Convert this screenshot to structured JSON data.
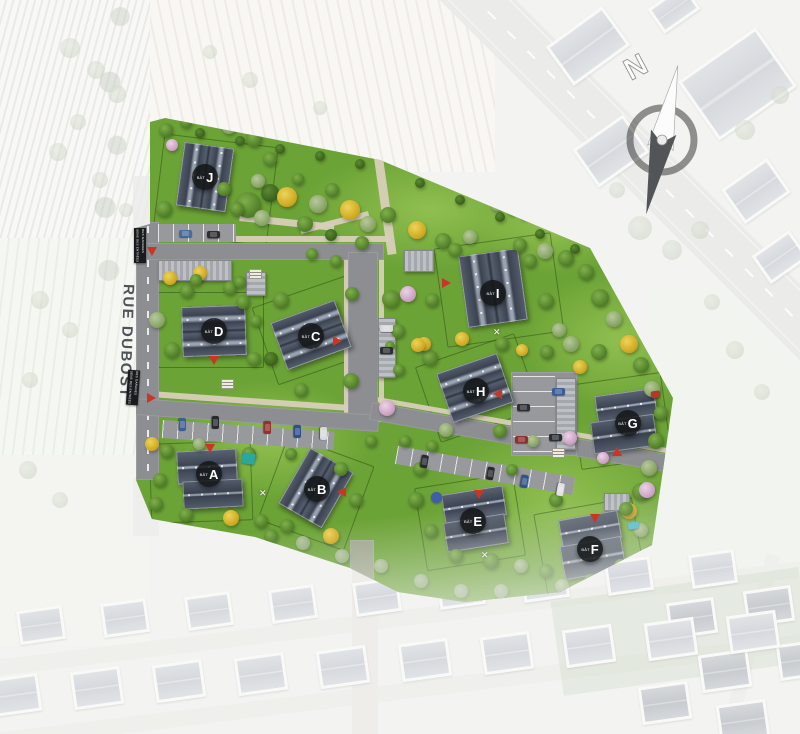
{
  "map": {
    "street_label": "RUE DUBOST",
    "compass": {
      "label": "N"
    },
    "building_prefix": "BÂT",
    "buildings": [
      {
        "id": "A",
        "badge": {
          "x": 209,
          "y": 474
        },
        "wings": [
          [
            177,
            450,
            60,
            33,
            -3,
            "1h"
          ],
          [
            183,
            480,
            60,
            28,
            -3,
            "1h"
          ]
        ]
      },
      {
        "id": "B",
        "badge": {
          "x": 317,
          "y": 489
        },
        "wings": [
          [
            291,
            456,
            50,
            64,
            30,
            "2v"
          ]
        ]
      },
      {
        "id": "C",
        "badge": {
          "x": 311,
          "y": 336
        },
        "wings": [
          [
            277,
            310,
            68,
            50,
            -20,
            "2h"
          ]
        ]
      },
      {
        "id": "D",
        "badge": {
          "x": 214,
          "y": 331
        },
        "wings": [
          [
            182,
            306,
            64,
            50,
            -2,
            "2h"
          ]
        ]
      },
      {
        "id": "E",
        "badge": {
          "x": 473,
          "y": 521
        },
        "wings": [
          [
            443,
            490,
            62,
            30,
            -9,
            "1h"
          ],
          [
            445,
            518,
            62,
            30,
            -9,
            "1h"
          ]
        ]
      },
      {
        "id": "F",
        "badge": {
          "x": 590,
          "y": 549
        },
        "wings": [
          [
            560,
            515,
            60,
            28,
            -10,
            "1h"
          ],
          [
            562,
            541,
            62,
            34,
            -10,
            "1h"
          ]
        ]
      },
      {
        "id": "G",
        "badge": {
          "x": 628,
          "y": 423
        },
        "wings": [
          [
            596,
            392,
            60,
            28,
            -8,
            "1h"
          ],
          [
            592,
            418,
            64,
            32,
            -8,
            "1h"
          ]
        ]
      },
      {
        "id": "H",
        "badge": {
          "x": 476,
          "y": 391
        },
        "wings": [
          [
            443,
            362,
            64,
            52,
            -19,
            "2h"
          ]
        ]
      },
      {
        "id": "I",
        "badge": {
          "x": 493,
          "y": 293
        },
        "wings": [
          [
            463,
            252,
            60,
            72,
            -8,
            "2v"
          ]
        ]
      },
      {
        "id": "J",
        "badge": {
          "x": 205,
          "y": 177
        },
        "wings": [
          [
            180,
            145,
            50,
            64,
            8,
            "2v"
          ]
        ]
      }
    ],
    "entrance_signs": [
      {
        "x": 134,
        "y": 228,
        "rot": 0,
        "lines": [
          "SENS DES ENTRÉES",
          "DES GARAGES"
        ]
      },
      {
        "x": 127,
        "y": 370,
        "rot": 4,
        "lines": [
          "SENS DES ENTRÉES",
          "DES GARAGES"
        ]
      }
    ],
    "arrows": [
      [
        152,
        252,
        "down"
      ],
      [
        152,
        398,
        "right"
      ],
      [
        210,
        449,
        "down"
      ],
      [
        214,
        361,
        "down"
      ],
      [
        338,
        341,
        "right"
      ],
      [
        342,
        492,
        "left"
      ],
      [
        498,
        394,
        "left"
      ],
      [
        447,
        283,
        "right"
      ],
      [
        479,
        495,
        "down"
      ],
      [
        595,
        519,
        "down"
      ],
      [
        617,
        452,
        "up"
      ]
    ],
    "lot_markers": [
      [
        249,
        269
      ],
      [
        221,
        379
      ],
      [
        552,
        448
      ]
    ],
    "crosses": [
      [
        497,
        332
      ],
      [
        263,
        493
      ],
      [
        485,
        555
      ]
    ],
    "items": [
      {
        "x": 248,
        "y": 458,
        "w": 13,
        "h": 11,
        "c": "#2aa89f",
        "rot": 8,
        "shape": "rect",
        "name": "play-tent"
      },
      {
        "x": 633,
        "y": 525,
        "w": 11,
        "h": 7,
        "c": "#49b8c8",
        "rot": -10,
        "shape": "rect",
        "name": "pool"
      },
      {
        "x": 436,
        "y": 497,
        "w": 11,
        "h": 11,
        "c": "#3f5da8",
        "rot": 0,
        "shape": "circle",
        "name": "parasol"
      },
      {
        "x": 655,
        "y": 394,
        "w": 9,
        "h": 7,
        "c": "#b5372a",
        "rot": -8,
        "shape": "rect",
        "name": "playhouse"
      }
    ],
    "cars": [
      [
        185,
        233,
        0,
        "#4a6c9d"
      ],
      [
        213,
        234,
        0,
        "#2b2f34"
      ],
      [
        182,
        424,
        90,
        "#3c5f95"
      ],
      [
        215,
        422,
        90,
        "#26292e"
      ],
      [
        267,
        427,
        90,
        "#93312e"
      ],
      [
        297,
        431,
        90,
        "#2f4f88"
      ],
      [
        323,
        433,
        90,
        "#d7d9da"
      ],
      [
        523,
        407,
        0,
        "#2b2f35"
      ],
      [
        558,
        391,
        0,
        "#3a5f97"
      ],
      [
        521,
        439,
        0,
        "#8f2f2f"
      ],
      [
        555,
        437,
        0,
        "#2b2f35"
      ],
      [
        424,
        461,
        100,
        "#26292e"
      ],
      [
        490,
        473,
        100,
        "#26292e"
      ],
      [
        524,
        481,
        100,
        "#2f5390"
      ],
      [
        560,
        489,
        100,
        "#e0e1e2"
      ],
      [
        386,
        328,
        0,
        "#d8d9da"
      ],
      [
        386,
        350,
        0,
        "#2b2f35"
      ]
    ],
    "trees": [
      [
        248,
        205,
        13,
        "g"
      ],
      [
        270,
        193,
        9,
        "d"
      ],
      [
        287,
        197,
        10,
        "y"
      ],
      [
        305,
        224,
        8,
        "g"
      ],
      [
        318,
        204,
        9,
        "p"
      ],
      [
        332,
        190,
        7,
        "g"
      ],
      [
        350,
        210,
        10,
        "y"
      ],
      [
        368,
        224,
        8,
        "p"
      ],
      [
        388,
        215,
        8,
        "g"
      ],
      [
        362,
        243,
        7,
        "g"
      ],
      [
        331,
        235,
        6,
        "d"
      ],
      [
        262,
        218,
        8,
        "p"
      ],
      [
        237,
        209,
        7,
        "g"
      ],
      [
        224,
        189,
        7,
        "g"
      ],
      [
        258,
        181,
        7,
        "p"
      ],
      [
        298,
        179,
        6,
        "g"
      ],
      [
        417,
        230,
        9,
        "y"
      ],
      [
        443,
        241,
        8,
        "g"
      ],
      [
        470,
        237,
        7,
        "p"
      ],
      [
        497,
        205,
        6,
        "p"
      ],
      [
        512,
        210,
        5,
        "p"
      ],
      [
        524,
        214,
        5,
        "g"
      ],
      [
        520,
        245,
        7,
        "g"
      ],
      [
        545,
        251,
        8,
        "p"
      ],
      [
        566,
        258,
        8,
        "g"
      ],
      [
        586,
        272,
        8,
        "g"
      ],
      [
        600,
        298,
        9,
        "g"
      ],
      [
        614,
        319,
        8,
        "p"
      ],
      [
        629,
        344,
        9,
        "y"
      ],
      [
        641,
        365,
        8,
        "g"
      ],
      [
        652,
        389,
        8,
        "p"
      ],
      [
        661,
        413,
        7,
        "g"
      ],
      [
        656,
        441,
        8,
        "g"
      ],
      [
        649,
        468,
        8,
        "p"
      ],
      [
        641,
        492,
        9,
        "g"
      ],
      [
        629,
        511,
        8,
        "y"
      ],
      [
        580,
        367,
        7,
        "y"
      ],
      [
        599,
        352,
        8,
        "g"
      ],
      [
        571,
        344,
        8,
        "p"
      ],
      [
        547,
        352,
        7,
        "g"
      ],
      [
        455,
        250,
        7,
        "g"
      ],
      [
        530,
        261,
        7,
        "g"
      ],
      [
        546,
        301,
        8,
        "g"
      ],
      [
        559,
        330,
        7,
        "p"
      ],
      [
        432,
        300,
        7,
        "g"
      ],
      [
        462,
        339,
        7,
        "y"
      ],
      [
        502,
        344,
        7,
        "g"
      ],
      [
        522,
        350,
        6,
        "y"
      ],
      [
        430,
        358,
        8,
        "g"
      ],
      [
        424,
        344,
        7,
        "y"
      ],
      [
        500,
        431,
        7,
        "g"
      ],
      [
        446,
        430,
        7,
        "p"
      ],
      [
        281,
        300,
        8,
        "g"
      ],
      [
        352,
        294,
        7,
        "g"
      ],
      [
        391,
        299,
        9,
        "g"
      ],
      [
        408,
        294,
        8,
        "k"
      ],
      [
        398,
        331,
        7,
        "g"
      ],
      [
        351,
        381,
        8,
        "g"
      ],
      [
        301,
        390,
        7,
        "g"
      ],
      [
        271,
        359,
        7,
        "d"
      ],
      [
        200,
        273,
        7,
        "y"
      ],
      [
        230,
        288,
        7,
        "g"
      ],
      [
        157,
        320,
        8,
        "p"
      ],
      [
        172,
        350,
        8,
        "g"
      ],
      [
        243,
        302,
        7,
        "g"
      ],
      [
        256,
        321,
        6,
        "g"
      ],
      [
        254,
        359,
        7,
        "g"
      ],
      [
        187,
        291,
        7,
        "g"
      ],
      [
        166,
        130,
        7,
        "g"
      ],
      [
        186,
        122,
        6,
        "g"
      ],
      [
        229,
        127,
        7,
        "p"
      ],
      [
        254,
        139,
        8,
        "g"
      ],
      [
        270,
        159,
        7,
        "g"
      ],
      [
        164,
        209,
        8,
        "g"
      ],
      [
        170,
        278,
        7,
        "y"
      ],
      [
        196,
        280,
        6,
        "g"
      ],
      [
        240,
        282,
        6,
        "g"
      ],
      [
        312,
        254,
        6,
        "g"
      ],
      [
        336,
        261,
        6,
        "g"
      ],
      [
        172,
        145,
        6,
        "k"
      ],
      [
        152,
        444,
        7,
        "y"
      ],
      [
        167,
        451,
        7,
        "g"
      ],
      [
        199,
        444,
        6,
        "p"
      ],
      [
        249,
        454,
        7,
        "g"
      ],
      [
        160,
        480,
        7,
        "g"
      ],
      [
        156,
        504,
        7,
        "g"
      ],
      [
        186,
        515,
        7,
        "g"
      ],
      [
        214,
        552,
        8,
        "k"
      ],
      [
        231,
        518,
        8,
        "y"
      ],
      [
        261,
        521,
        7,
        "g"
      ],
      [
        287,
        526,
        7,
        "g"
      ],
      [
        291,
        454,
        6,
        "g"
      ],
      [
        341,
        469,
        7,
        "g"
      ],
      [
        356,
        500,
        7,
        "g"
      ],
      [
        331,
        536,
        8,
        "y"
      ],
      [
        271,
        536,
        7,
        "g"
      ],
      [
        303,
        543,
        7,
        "f"
      ],
      [
        420,
        469,
        7,
        "g"
      ],
      [
        432,
        446,
        6,
        "g"
      ],
      [
        416,
        500,
        8,
        "g"
      ],
      [
        431,
        531,
        7,
        "g"
      ],
      [
        456,
        556,
        7,
        "g"
      ],
      [
        491,
        561,
        8,
        "g"
      ],
      [
        521,
        566,
        7,
        "p"
      ],
      [
        546,
        571,
        7,
        "g"
      ],
      [
        556,
        500,
        7,
        "g"
      ],
      [
        626,
        509,
        7,
        "g"
      ],
      [
        641,
        530,
        7,
        "p"
      ],
      [
        652,
        551,
        7,
        "g"
      ],
      [
        621,
        566,
        7,
        "g"
      ],
      [
        591,
        581,
        7,
        "g"
      ],
      [
        562,
        586,
        7,
        "p"
      ],
      [
        647,
        490,
        8,
        "k"
      ],
      [
        342,
        556,
        7,
        "f"
      ],
      [
        381,
        566,
        7,
        "f"
      ],
      [
        421,
        581,
        7,
        "f"
      ],
      [
        461,
        591,
        7,
        "f"
      ],
      [
        501,
        591,
        7,
        "f"
      ],
      [
        387,
        408,
        8,
        "k"
      ],
      [
        399,
        370,
        6,
        "g"
      ],
      [
        390,
        346,
        5,
        "g"
      ],
      [
        371,
        441,
        6,
        "g"
      ],
      [
        405,
        441,
        6,
        "g"
      ],
      [
        418,
        345,
        7,
        "y"
      ],
      [
        570,
        438,
        7,
        "k"
      ],
      [
        533,
        441,
        6,
        "p"
      ],
      [
        603,
        458,
        6,
        "k"
      ],
      [
        512,
        470,
        6,
        "g"
      ],
      [
        200,
        133,
        5,
        "d"
      ],
      [
        240,
        141,
        5,
        "d"
      ],
      [
        280,
        149,
        5,
        "d"
      ],
      [
        320,
        156,
        5,
        "d"
      ],
      [
        360,
        164,
        5,
        "d"
      ],
      [
        420,
        183,
        5,
        "d"
      ],
      [
        460,
        200,
        5,
        "d"
      ],
      [
        500,
        217,
        5,
        "d"
      ],
      [
        540,
        234,
        5,
        "d"
      ],
      [
        575,
        249,
        5,
        "d"
      ]
    ],
    "colors": {
      "grass": "#6ca336",
      "roof": "#3d4554",
      "road": "#8c8e91",
      "path": "#d8cfba",
      "accent_red": "#cc3524",
      "badge_bg": "#141618"
    }
  }
}
